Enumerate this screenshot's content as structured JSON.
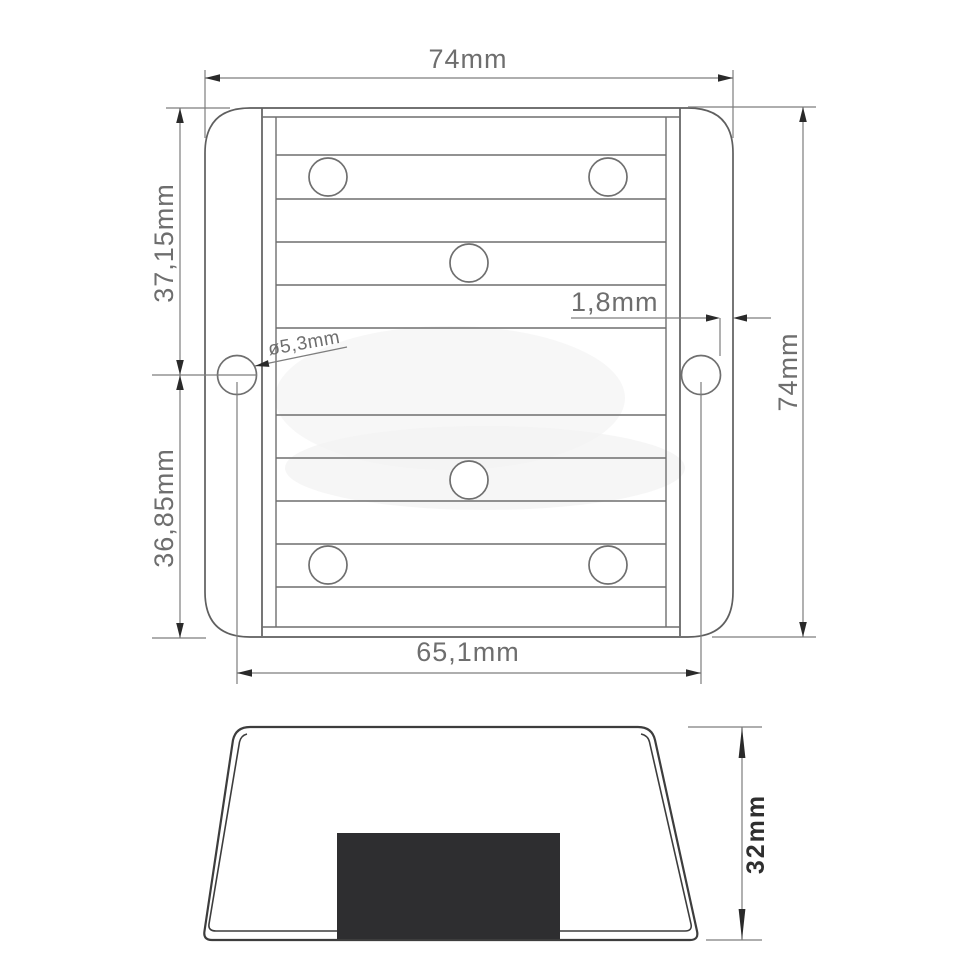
{
  "drawing": {
    "background": "#ffffff",
    "line_color": "#6f6f6f",
    "dim_text_color": "#6e6e6e",
    "bold_text_color": "#2f2f2f",
    "connector_color": "#2e2e30",
    "top_view": {
      "label": "top view",
      "dim_overall_width": "74mm",
      "dim_overall_height": "74mm",
      "dim_upper_offset": "37,15mm",
      "dim_lower_offset": "36,85mm",
      "dim_hole_spacing": "65,1mm",
      "dim_edge_gap": "1,8mm",
      "dim_hole_diameter": "ø5,3mm",
      "screw_hole_count": 6,
      "mount_hole_count": 2,
      "fin_line_count": 10
    },
    "side_view": {
      "label": "side view",
      "dim_height": "32mm"
    }
  }
}
